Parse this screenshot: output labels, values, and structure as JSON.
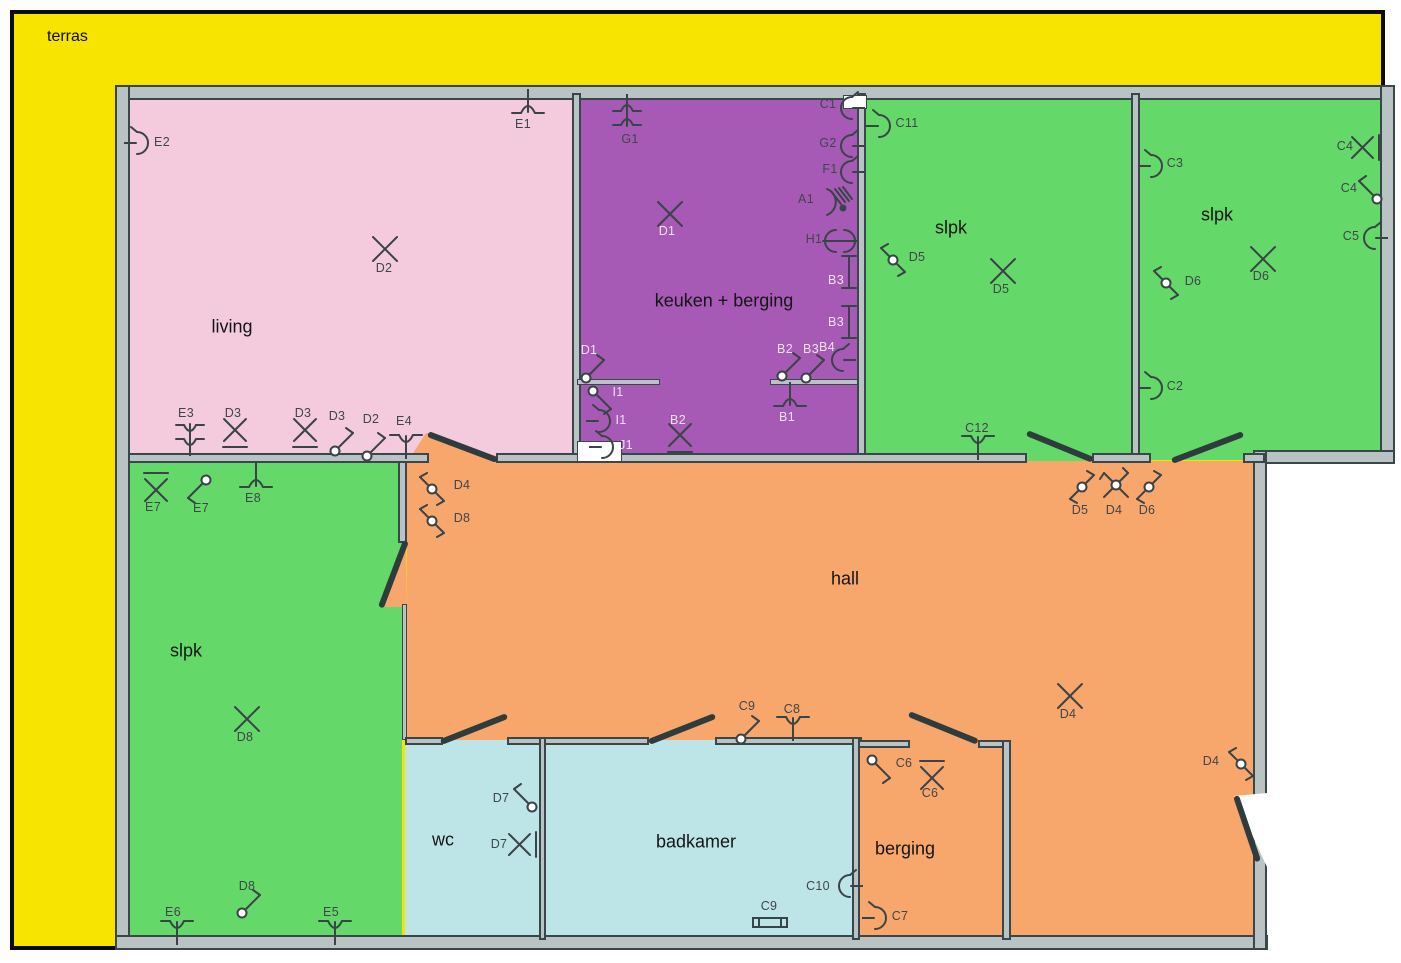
{
  "title": "Elektrisch plan gelijkvloers",
  "colors": {
    "yellow": "#f7e400",
    "pink": "#f3cbdc",
    "purple": "#a65ab6",
    "green": "#64d869",
    "orange": "#f7a66c",
    "cyan": "#bde5e8",
    "wall_fill": "#b9c3c4",
    "wall_edge": "#39464a",
    "symbol_stroke": "#3a4347",
    "outline_black": "#0c0c0c"
  },
  "terras": {
    "label": "terras",
    "x": 47,
    "y": 28
  },
  "rooms": [
    {
      "id": "living",
      "label": "living",
      "color": "pink",
      "x": 128,
      "y": 93,
      "w": 447,
      "h": 370,
      "lx": 232,
      "ly": 327,
      "fs": 18
    },
    {
      "id": "keuken",
      "label": "keuken + berging",
      "color": "purple",
      "x": 577,
      "y": 93,
      "w": 283,
      "h": 370,
      "lx": 724,
      "ly": 301,
      "fs": 18
    },
    {
      "id": "slpk-1",
      "label": "slpk",
      "color": "green",
      "x": 863,
      "y": 93,
      "w": 271,
      "h": 370,
      "lx": 951,
      "ly": 228,
      "fs": 18
    },
    {
      "id": "slpk-2",
      "label": "slpk",
      "color": "green",
      "x": 1137,
      "y": 93,
      "w": 246,
      "h": 367,
      "lx": 1217,
      "ly": 215,
      "fs": 18
    },
    {
      "id": "slpk-3",
      "label": "slpk",
      "color": "green",
      "x": 128,
      "y": 460,
      "w": 274,
      "h": 480,
      "lx": 186,
      "ly": 651,
      "fs": 18
    },
    {
      "id": "hall-top",
      "label": "hall",
      "color": "orange",
      "x": 407,
      "y": 461,
      "w": 848,
      "h": 279,
      "lx": 845,
      "ly": 579,
      "fs": 18
    },
    {
      "id": "hall-right",
      "label": "",
      "color": "orange",
      "x": 1010,
      "y": 740,
      "w": 245,
      "h": 200,
      "lx": 0,
      "ly": 0,
      "fs": 0
    },
    {
      "id": "wc",
      "label": "wc",
      "color": "cyan",
      "x": 405,
      "y": 740,
      "w": 138,
      "h": 200,
      "lx": 443,
      "ly": 840,
      "fs": 18
    },
    {
      "id": "badkamer",
      "label": "badkamer",
      "color": "cyan",
      "x": 543,
      "y": 740,
      "w": 313,
      "h": 200,
      "lx": 696,
      "ly": 842,
      "fs": 18
    },
    {
      "id": "berging",
      "label": "berging",
      "color": "orange",
      "x": 858,
      "y": 740,
      "w": 148,
      "h": 200,
      "lx": 905,
      "ly": 849,
      "fs": 18
    }
  ],
  "symbols": [
    {
      "t": "lamp",
      "x": 528,
      "y": 107,
      "tr": "rot180",
      "l": "E1",
      "lx": 523,
      "ly": 124
    },
    {
      "t": "socket",
      "x": 142,
      "y": 143,
      "l": "E2",
      "lx": 162,
      "ly": 142
    },
    {
      "t": "x",
      "x": 385,
      "y": 249,
      "l": "D2",
      "lx": 384,
      "ly": 268
    },
    {
      "t": "lamp2",
      "x": 190,
      "y": 438,
      "l": "E3",
      "lx": 186,
      "ly": 413
    },
    {
      "t": "x_under",
      "x": 235,
      "y": 432,
      "l": "D3",
      "lx": 233,
      "ly": 413
    },
    {
      "t": "x_under",
      "x": 305,
      "y": 432,
      "l": "D3",
      "lx": 303,
      "ly": 413
    },
    {
      "t": "sw1",
      "x": 343,
      "y": 442,
      "l": "D3",
      "lx": 337,
      "ly": 416
    },
    {
      "t": "sw1",
      "x": 375,
      "y": 447,
      "l": "D2",
      "lx": 371,
      "ly": 419
    },
    {
      "t": "lamp",
      "x": 406,
      "y": 441,
      "l": "E4",
      "lx": 404,
      "ly": 421
    },
    {
      "t": "x_over",
      "x": 156,
      "y": 488,
      "l": "E7",
      "lx": 153,
      "ly": 507
    },
    {
      "t": "sw1",
      "x": 198,
      "y": 489,
      "tr": "rot180",
      "l": "E7",
      "lx": 201,
      "ly": 508
    },
    {
      "t": "lamp",
      "x": 256,
      "y": 481,
      "tr": "rot180",
      "l": "E8",
      "lx": 253,
      "ly": 498
    },
    {
      "t": "x",
      "x": 247,
      "y": 719,
      "l": "D8",
      "lx": 245,
      "ly": 737
    },
    {
      "t": "sw1",
      "x": 250,
      "y": 904,
      "l": "D8",
      "lx": 247,
      "ly": 886
    },
    {
      "t": "lamp",
      "x": 177,
      "y": 927,
      "l": "E6",
      "lx": 173,
      "ly": 912
    },
    {
      "t": "lamp",
      "x": 335,
      "y": 927,
      "l": "E5",
      "lx": 331,
      "ly": 912
    },
    {
      "t": "lamp2",
      "x": 627,
      "y": 112,
      "tr": "rot180",
      "l": "G1",
      "lx": 630,
      "ly": 139
    },
    {
      "t": "x",
      "x": 670,
      "y": 214,
      "l": "D1",
      "lx": 667,
      "ly": 231,
      "lt": 1
    },
    {
      "t": "socket",
      "x": 847,
      "y": 108,
      "tr": "flipx",
      "l": "C1",
      "lx": 828,
      "ly": 104
    },
    {
      "t": "socket",
      "x": 847,
      "y": 146,
      "tr": "flipx",
      "l": "G2",
      "lx": 828,
      "ly": 143
    },
    {
      "t": "socket",
      "x": 847,
      "y": 172,
      "tr": "flipx",
      "l": "F1",
      "lx": 830,
      "ly": 169
    },
    {
      "t": "panel",
      "x": 836,
      "y": 202,
      "l": "A1",
      "lx": 806,
      "ly": 199
    },
    {
      "t": "sock2",
      "x": 840,
      "y": 241,
      "l": "H1",
      "lx": 814,
      "ly": 239
    },
    {
      "t": "tl_v",
      "x": 849,
      "y": 272,
      "l": "B3",
      "lx": 836,
      "ly": 280,
      "lt": 1
    },
    {
      "t": "tl_v",
      "x": 849,
      "y": 322,
      "l": "B3",
      "lx": 836,
      "ly": 322,
      "lt": 1
    },
    {
      "t": "sw1",
      "x": 790,
      "y": 367,
      "l": "B2",
      "lx": 785,
      "ly": 349,
      "lt": 1
    },
    {
      "t": "sw1",
      "x": 814,
      "y": 369,
      "l": "B3",
      "lx": 811,
      "ly": 349,
      "lt": 1
    },
    {
      "t": "socket",
      "x": 838,
      "y": 360,
      "tr": "flipx",
      "l": "B4",
      "lx": 827,
      "ly": 347,
      "lt": 1
    },
    {
      "t": "lamp",
      "x": 790,
      "y": 400,
      "tr": "rot180",
      "l": "B1",
      "lx": 787,
      "ly": 417,
      "lt": 1
    },
    {
      "t": "x_under",
      "x": 680,
      "y": 437,
      "l": "B2",
      "lx": 678,
      "ly": 420,
      "lt": 1
    },
    {
      "t": "sw1",
      "x": 594,
      "y": 369,
      "l": "D1",
      "lx": 589,
      "ly": 350,
      "lt": 1
    },
    {
      "t": "sw1",
      "x": 601,
      "y": 400,
      "tr": "flipy",
      "l": "I1",
      "lx": 618,
      "ly": 392,
      "lt": 1
    },
    {
      "t": "socket",
      "x": 604,
      "y": 421,
      "l": "I1",
      "lx": 621,
      "ly": 420,
      "lt": 1
    },
    {
      "t": "socket",
      "x": 607,
      "y": 447,
      "l": "J1",
      "lx": 626,
      "ly": 445,
      "lt": 1
    },
    {
      "t": "socket",
      "x": 884,
      "y": 126,
      "l": "C11",
      "lx": 907,
      "ly": 123
    },
    {
      "t": "sw2",
      "x": 893,
      "y": 260,
      "tr": "flipx",
      "l": "D5",
      "lx": 917,
      "ly": 257
    },
    {
      "t": "x",
      "x": 1003,
      "y": 271,
      "l": "D5",
      "lx": 1001,
      "ly": 289
    },
    {
      "t": "lamp",
      "x": 978,
      "y": 442,
      "l": "C12",
      "lx": 977,
      "ly": 428
    },
    {
      "t": "socket",
      "x": 1156,
      "y": 166,
      "l": "C3",
      "lx": 1175,
      "ly": 163
    },
    {
      "t": "x_bar",
      "x": 1365,
      "y": 148,
      "l": "C4",
      "lx": 1345,
      "ly": 146
    },
    {
      "t": "sw1",
      "x": 1369,
      "y": 190,
      "tr": "flipx",
      "l": "C4",
      "lx": 1349,
      "ly": 188
    },
    {
      "t": "socket",
      "x": 1370,
      "y": 238,
      "tr": "flipx",
      "l": "C5",
      "lx": 1351,
      "ly": 236
    },
    {
      "t": "x",
      "x": 1263,
      "y": 259,
      "l": "D6",
      "lx": 1261,
      "ly": 276
    },
    {
      "t": "sw2",
      "x": 1166,
      "y": 283,
      "tr": "flipx",
      "l": "D6",
      "lx": 1193,
      "ly": 281
    },
    {
      "t": "socket",
      "x": 1156,
      "y": 388,
      "l": "C2",
      "lx": 1175,
      "ly": 386
    },
    {
      "t": "sw2",
      "x": 432,
      "y": 489,
      "tr": "flipx",
      "l": "D4",
      "lx": 462,
      "ly": 485
    },
    {
      "t": "sw2",
      "x": 432,
      "y": 521,
      "tr": "flipx",
      "l": "D8",
      "lx": 462,
      "ly": 518
    },
    {
      "t": "sw2",
      "x": 1082,
      "y": 487,
      "l": "D5",
      "lx": 1080,
      "ly": 510
    },
    {
      "t": "swx",
      "x": 1116,
      "y": 485,
      "l": "D4",
      "lx": 1114,
      "ly": 510
    },
    {
      "t": "sw2",
      "x": 1149,
      "y": 487,
      "l": "D6",
      "lx": 1147,
      "ly": 510
    },
    {
      "t": "x",
      "x": 1070,
      "y": 696,
      "l": "D4",
      "lx": 1068,
      "ly": 714
    },
    {
      "t": "sw2",
      "x": 1241,
      "y": 764,
      "tr": "flipx",
      "l": "D4",
      "lx": 1211,
      "ly": 761
    },
    {
      "t": "sw1",
      "x": 749,
      "y": 730,
      "l": "C9",
      "lx": 747,
      "ly": 706
    },
    {
      "t": "lamp",
      "x": 793,
      "y": 723,
      "l": "C8",
      "lx": 792,
      "ly": 709
    },
    {
      "t": "sw1",
      "x": 524,
      "y": 798,
      "tr": "flipx",
      "l": "D7",
      "lx": 501,
      "ly": 798
    },
    {
      "t": "x_bar",
      "x": 522,
      "y": 845,
      "l": "D7",
      "lx": 499,
      "ly": 844
    },
    {
      "t": "socket",
      "x": 845,
      "y": 886,
      "tr": "flipx",
      "l": "C10",
      "lx": 818,
      "ly": 886
    },
    {
      "t": "tl_h",
      "x": 770,
      "y": 922,
      "l": "C9",
      "lx": 769,
      "ly": 906
    },
    {
      "t": "sw1",
      "x": 880,
      "y": 769,
      "tr": "flipy",
      "l": "C6",
      "lx": 904,
      "ly": 763
    },
    {
      "t": "x_over",
      "x": 932,
      "y": 776,
      "l": "C6",
      "lx": 930,
      "ly": 793
    },
    {
      "t": "socket",
      "x": 880,
      "y": 918,
      "l": "C7",
      "lx": 900,
      "ly": 916
    }
  ]
}
